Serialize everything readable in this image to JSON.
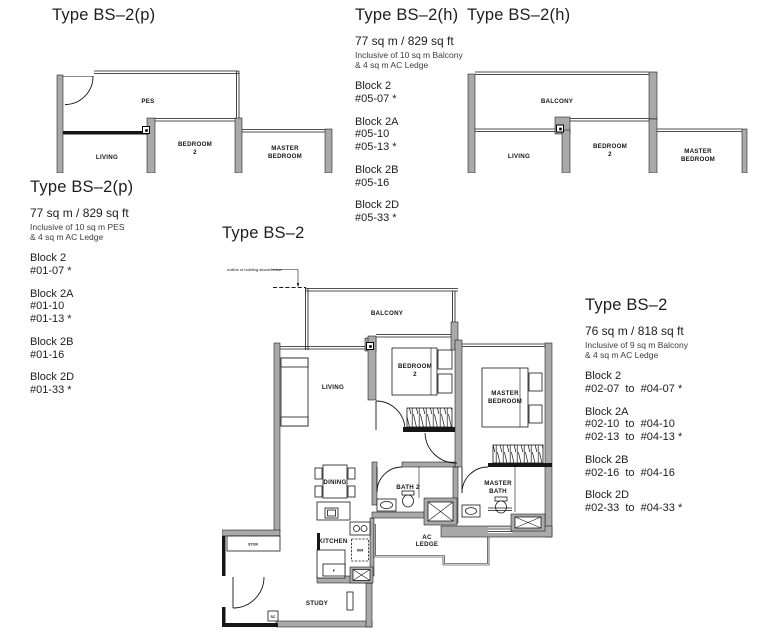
{
  "page": {
    "background": "#ffffff",
    "wall_color": "#a9a9a9",
    "line_color": "#161616"
  },
  "plan_p": {
    "title": "Type BS–2(p)",
    "labels": {
      "pes": "PES",
      "living": "LIVING",
      "bedroom2_1": "BEDROOM",
      "bedroom2_2": "2",
      "master_1": "MASTER",
      "master_2": "BEDROOM"
    }
  },
  "plan_h": {
    "title": "Type BS–2(h)",
    "labels": {
      "balcony": "BALCONY",
      "living": "LIVING",
      "bedroom2_1": "BEDROOM",
      "bedroom2_2": "2",
      "master_1": "MASTER",
      "master_2": "BEDROOM"
    }
  },
  "plan_main": {
    "title": "Type BS–2",
    "annotation": "outline of building above/below",
    "labels": {
      "balcony": "BALCONY",
      "living": "LIVING",
      "bedroom2_1": "BEDROOM",
      "bedroom2_2": "2",
      "master_1": "MASTER",
      "master_2": "BEDROOM",
      "dining": "DINING",
      "bath2": "BATH 2",
      "masterbath_1": "MASTER",
      "masterbath_2": "BATH",
      "kitchen": "KITCHEN",
      "study": "STUDY",
      "ac_1": "AC",
      "ac_2": "LEDGE",
      "store": "STOR",
      "shoe_cabinet": "SC",
      "washer": "WM",
      "fridge": "F"
    }
  },
  "info_p": {
    "title": "Type BS–2(p)",
    "area": "77 sq m / 829 sq ft",
    "note1": "Inclusive of 10 sq m PES",
    "note2": "& 4 sq m AC Ledge",
    "groups": [
      {
        "block": "Block 2",
        "lines": [
          "#01-07 *"
        ]
      },
      {
        "block": "Block 2A",
        "lines": [
          "#01-10",
          "#01-13 *"
        ]
      },
      {
        "block": "Block 2B",
        "lines": [
          "#01-16"
        ]
      },
      {
        "block": "Block 2D",
        "lines": [
          "#01-33 *"
        ]
      }
    ]
  },
  "info_h": {
    "title": "Type BS–2(h)",
    "area": "77 sq m / 829 sq ft",
    "note1": "Inclusive of 10 sq m Balcony",
    "note2": "& 4 sq m AC Ledge",
    "groups": [
      {
        "block": "Block 2",
        "lines": [
          "#05-07 *"
        ]
      },
      {
        "block": "Block 2A",
        "lines": [
          "#05-10",
          "#05-13 *"
        ]
      },
      {
        "block": "Block 2B",
        "lines": [
          "#05-16"
        ]
      },
      {
        "block": "Block 2D",
        "lines": [
          "#05-33 *"
        ]
      }
    ]
  },
  "info_main": {
    "title": "Type BS–2",
    "area": "76 sq m / 818 sq ft",
    "note1": "Inclusive of 9 sq m Balcony",
    "note2": "& 4 sq m AC Ledge",
    "groups": [
      {
        "block": "Block 2",
        "lines": [
          "#02-07  to  #04-07 *"
        ]
      },
      {
        "block": "Block 2A",
        "lines": [
          "#02-10  to  #04-10",
          "#02-13  to  #04-13 *"
        ]
      },
      {
        "block": "Block 2B",
        "lines": [
          "#02-16  to  #04-16"
        ]
      },
      {
        "block": "Block 2D",
        "lines": [
          "#02-33  to  #04-33 *"
        ]
      }
    ]
  }
}
